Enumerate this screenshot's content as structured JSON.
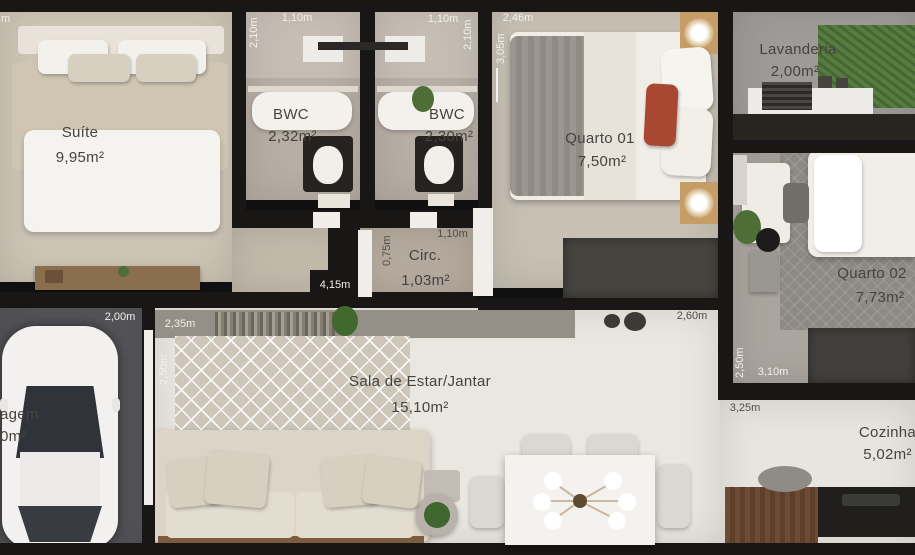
{
  "plan_title": "apartment-floor-plan",
  "rooms": {
    "suite": {
      "label": "Suíte",
      "area": "9,95m²"
    },
    "bwc1": {
      "label": "BWC",
      "area": "2,32m²"
    },
    "bwc2": {
      "label": "BWC",
      "area": "2,30m²"
    },
    "quarto01": {
      "label": "Quarto 01",
      "area": "7,50m²"
    },
    "lavanderia": {
      "label": "Lavanderia",
      "area": "2,00m²"
    },
    "quarto02": {
      "label": "Quarto 02",
      "area": "7,73m²"
    },
    "circ": {
      "label": "Circ.",
      "area": "1,03m²"
    },
    "sala": {
      "label": "Sala de Estar/Jantar",
      "area": "15,10m²"
    },
    "cozinha": {
      "label": "Cozinha",
      "area": "5,02m²"
    },
    "garagem": {
      "label": "agem",
      "area": "0m²"
    }
  },
  "dims": {
    "top_left_fragment": "m",
    "bwc1_width": "1,10m",
    "bwc1_height": "2,10m",
    "bwc2_width": "1,10m",
    "bwc2_height": "2,10m",
    "quarto01_width": "2,46m",
    "quarto01_height": "3,05m",
    "circ_height": "0,75m",
    "circ_width": "1,10m",
    "hall_length": "4,15m",
    "garagem_width": "2,00m",
    "sala_rug_width": "2,35m",
    "sala_height": "2,50m",
    "sala_right_width": "2,60m",
    "quarto02_height": "2,50m",
    "quarto02_width": "3,10m",
    "cozinha_width": "3,25m"
  },
  "colors": {
    "wall": "#191715",
    "floor_beige": "#cdc5b5",
    "floor_white": "#eae7e1",
    "garage_gray": "#56565a",
    "grass_green": "#567c40",
    "accent_red": "#a94832"
  }
}
